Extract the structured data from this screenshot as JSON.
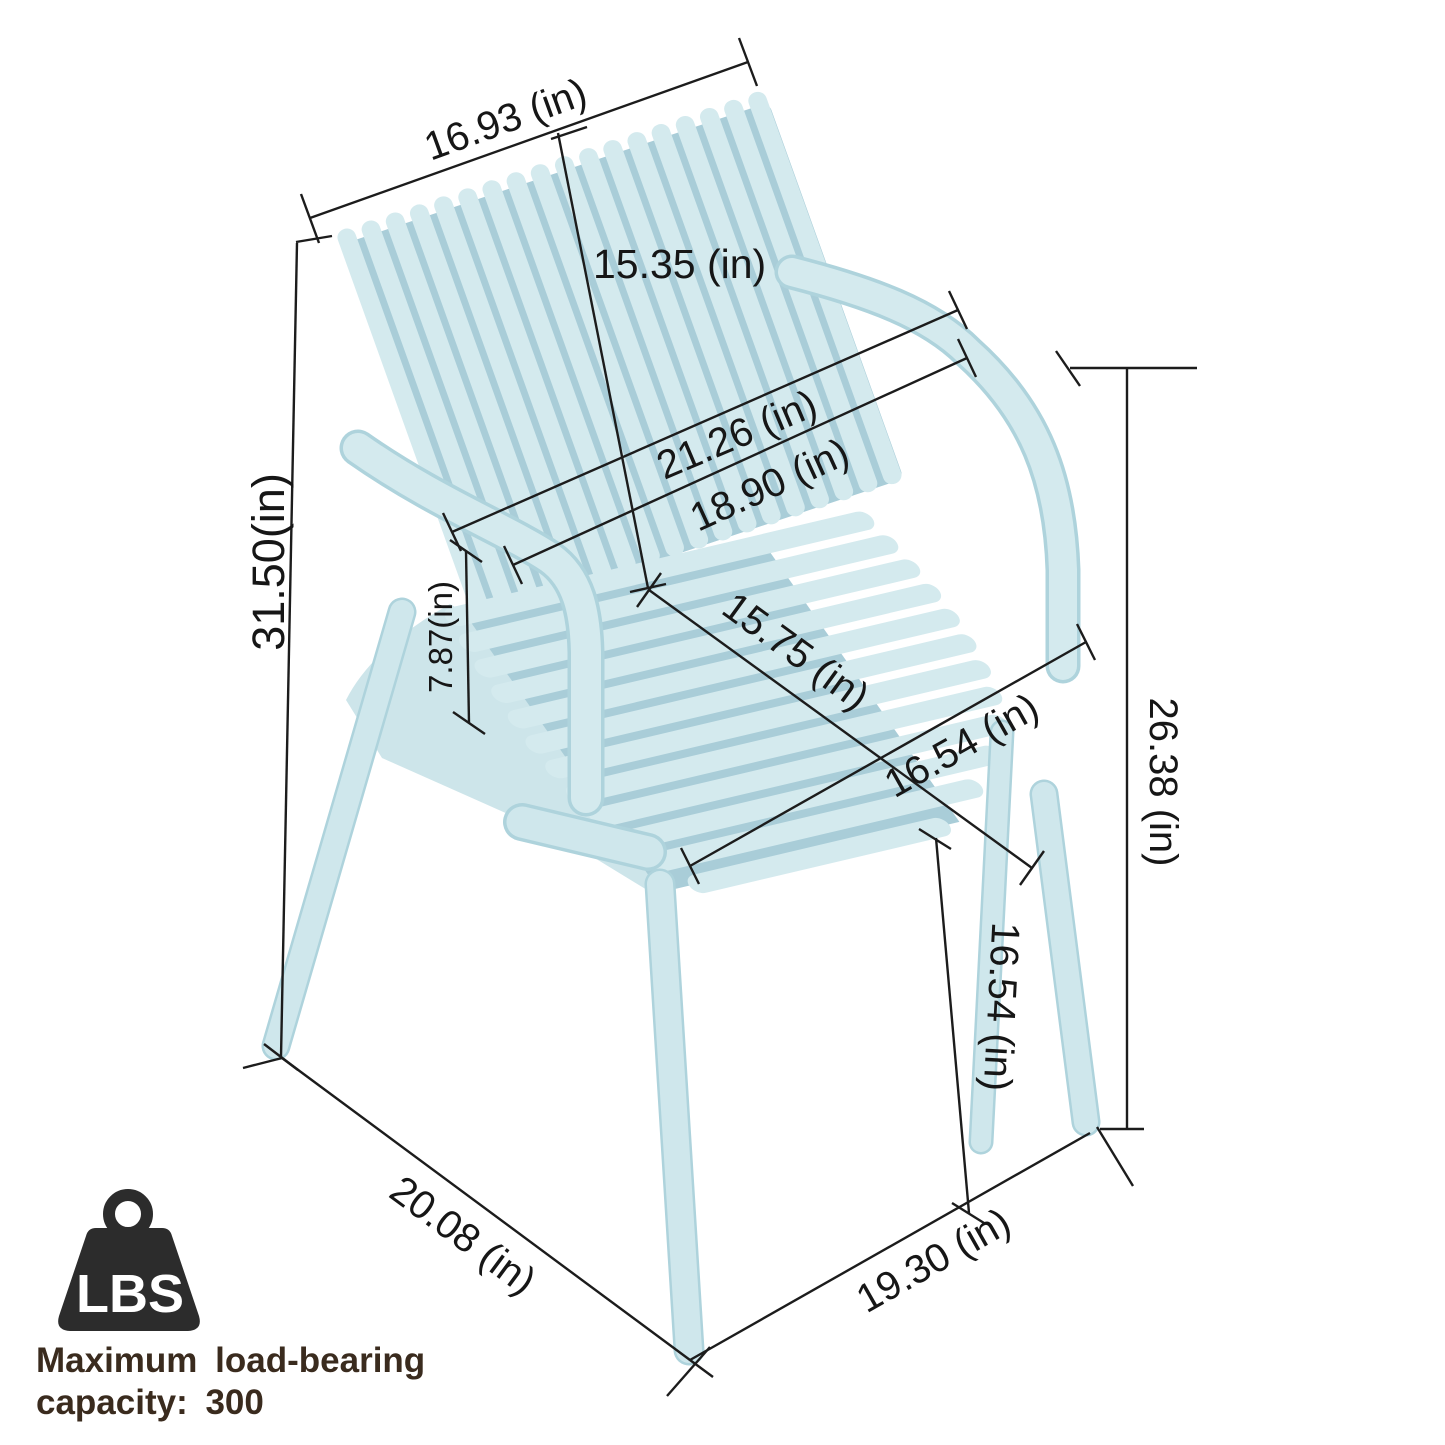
{
  "product": {
    "type": "stackable plastic armchair dimension diagram",
    "chair_color": "#d4eaee",
    "chair_shadow_color": "#a9cdd8",
    "line_color": "#1c1c1c",
    "caption_color": "#3a2b1e"
  },
  "dims": {
    "back_top_width": {
      "label": "16.93  (in)"
    },
    "back_height": {
      "label": "15.35  (in)"
    },
    "width_top": {
      "label": "21.26  (in)"
    },
    "width_mid": {
      "label": "18.90  (in)"
    },
    "total_height": {
      "label": "31.50(in)"
    },
    "arm_to_seat": {
      "label": "7.87(in)"
    },
    "seat_depth": {
      "label": "15.75  (in)"
    },
    "seat_width": {
      "label": "16.54  (in)"
    },
    "arm_height": {
      "label": "26.38  (in)"
    },
    "seat_height": {
      "label": "16.54  (in)"
    },
    "base_depth": {
      "label": "20.08  (in)"
    },
    "base_width": {
      "label": "19.30  (in)"
    }
  },
  "load": {
    "icon_label": "LBS",
    "caption_line1": "Maximum load-bearing",
    "caption_line2": "capacity: 300"
  }
}
